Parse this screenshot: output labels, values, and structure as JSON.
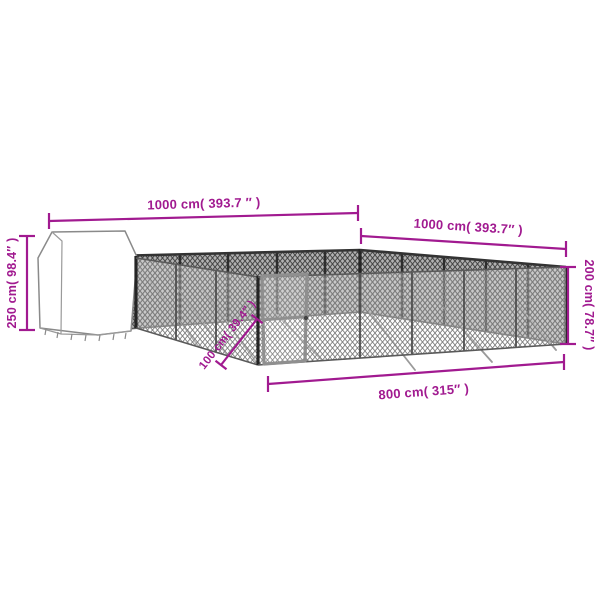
{
  "illustration": {
    "kind": "product-dimension-diagram",
    "subject": "outdoor-dog-kennel-with-shelter",
    "colors": {
      "dimension_accent": "#a11a90",
      "background": "#ffffff",
      "mesh_dark": "#474747",
      "mesh_light": "#7d7d7d"
    },
    "labels": {
      "top_width": "1000 cm( 393.7 ″ )",
      "right_width": "1000 cm( 393.7″ )",
      "shelter_height": "250 cm( 98.4″ )",
      "fence_height": "200 cm( 78.7″ )",
      "front_width": "800 cm( 315″ )",
      "door_width": "100 cm( 39.4″ )"
    }
  }
}
